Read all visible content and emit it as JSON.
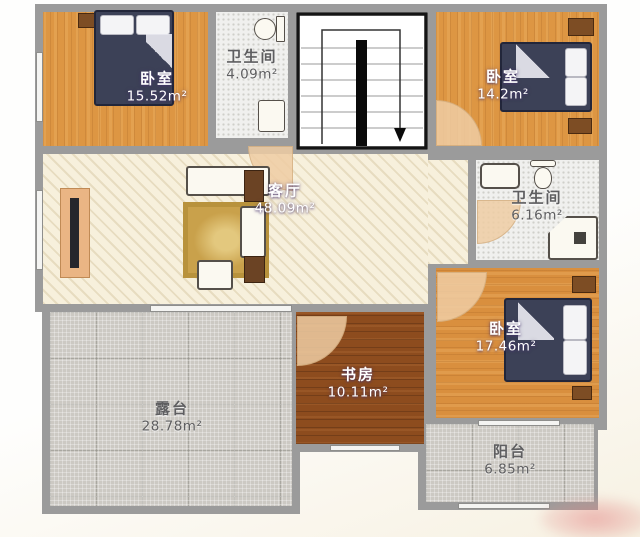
{
  "plan": {
    "title": "second-floor residential floor plan",
    "rooms": [
      {
        "id": "bedroom-top-left",
        "name": "卧室",
        "area": "15.52m²"
      },
      {
        "id": "bathroom-top",
        "name": "卫生间",
        "area": "4.09m²"
      },
      {
        "id": "bedroom-top-right",
        "name": "卧室",
        "area": "14.2m²"
      },
      {
        "id": "living-room",
        "name": "客厅",
        "area": "48.09m²"
      },
      {
        "id": "bathroom-right",
        "name": "卫生间",
        "area": "6.16m²"
      },
      {
        "id": "bedroom-bottom-right",
        "name": "卧室",
        "area": "17.46m²"
      },
      {
        "id": "study",
        "name": "书房",
        "area": "10.11m²"
      },
      {
        "id": "terrace",
        "name": "露台",
        "area": "28.78m²"
      },
      {
        "id": "balcony",
        "name": "阳台",
        "area": "6.85m²"
      }
    ],
    "stairwell": {
      "direction": "down",
      "icons": {
        "stairs-direction-arrow": "▼"
      }
    },
    "colors": {
      "wall": "#9b9b9b",
      "bedroom_floor": "#dd9643",
      "living_floor": "#f7f0dc",
      "study_floor": "#8d4c1e",
      "terrace_floor": "#ccc9c3",
      "bathroom_floor": "#f0f0ee",
      "bed": "#3c4157",
      "furniture_wood": "#6b4324",
      "door_arc": "#eecda3"
    }
  }
}
